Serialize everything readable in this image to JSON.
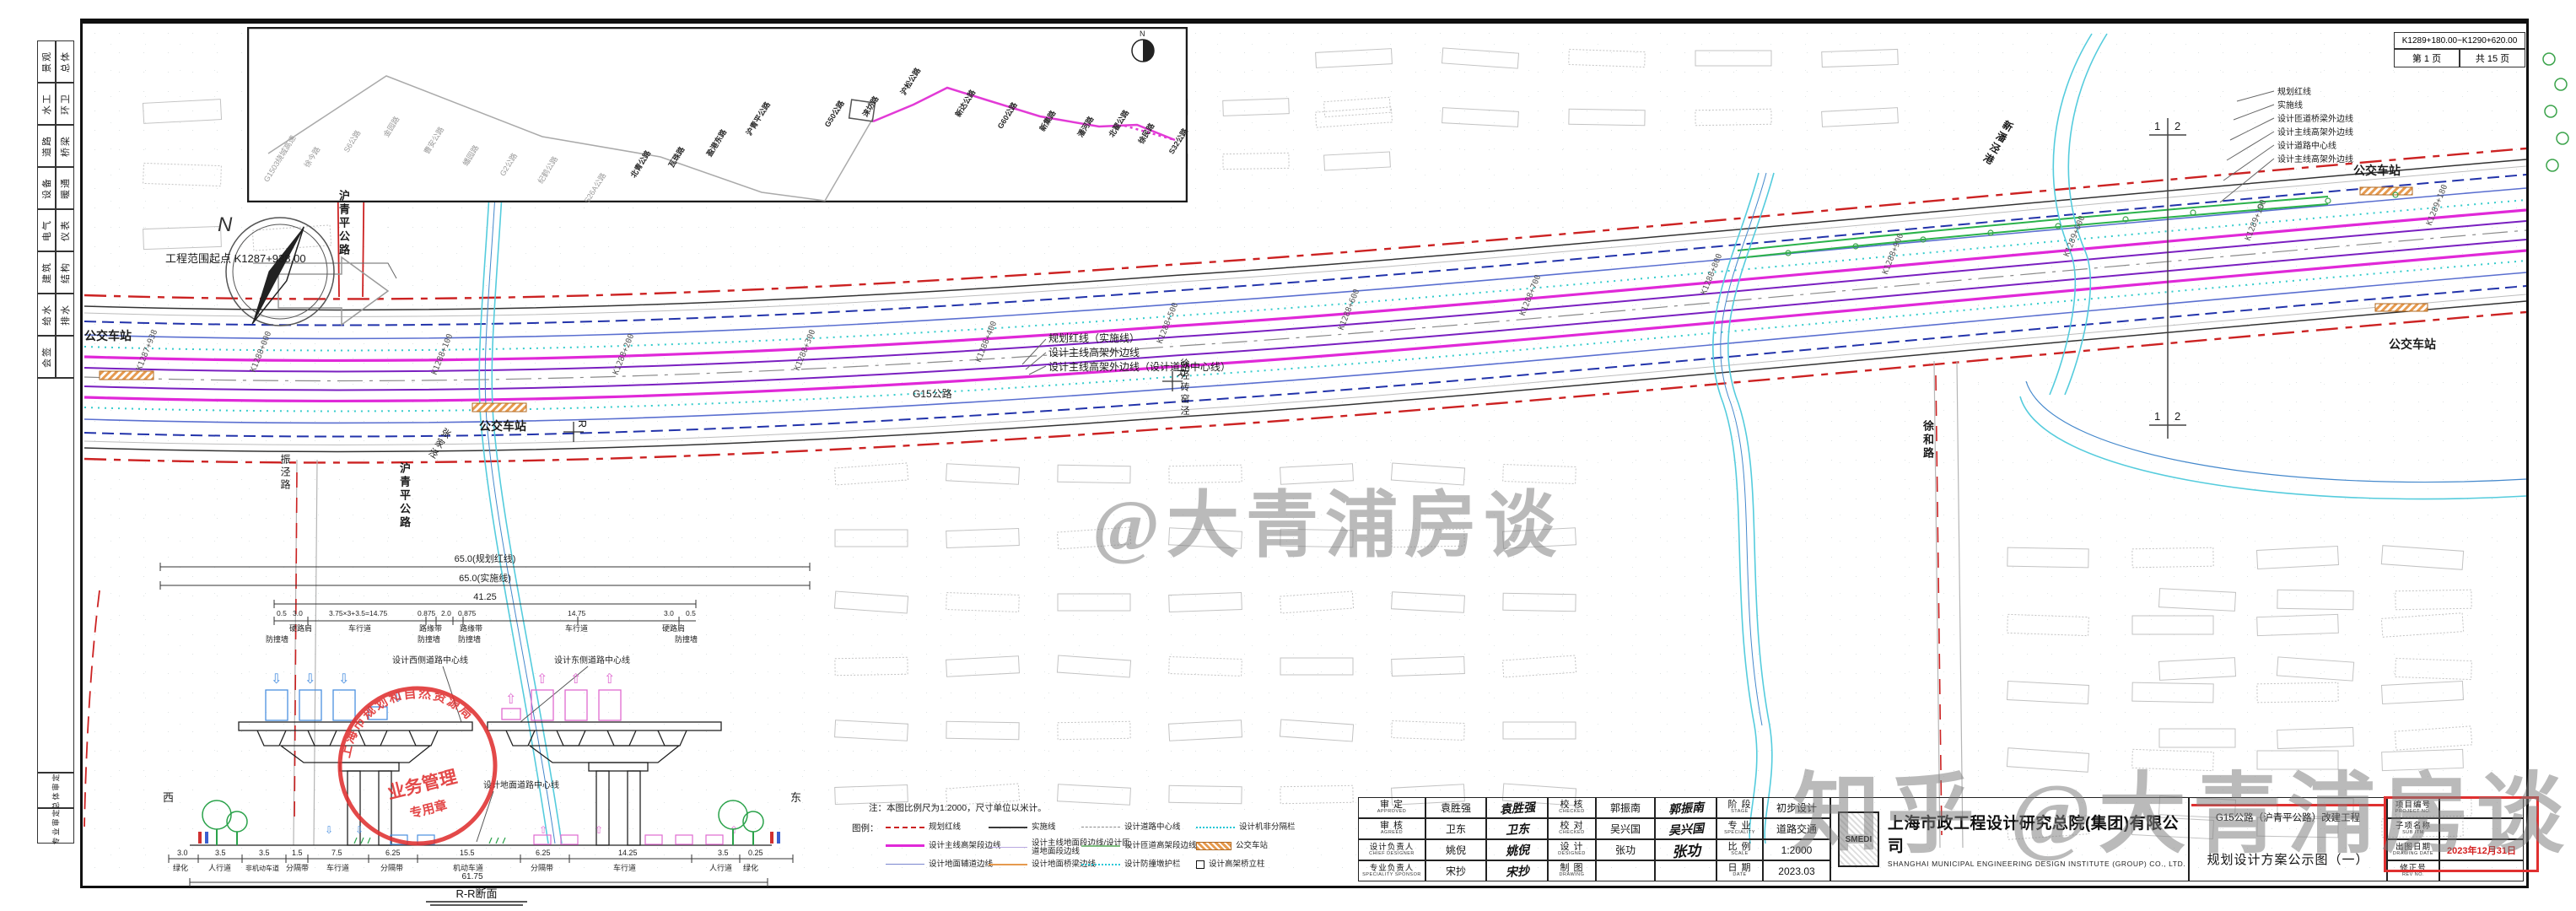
{
  "header_table": {
    "range": "K1289+180.00~K1290+620.00",
    "page": "第 1 页",
    "total": "共 15 页"
  },
  "sign_strip": {
    "rows": [
      {
        "a": "景观",
        "b": "总体"
      },
      {
        "a": "水工",
        "b": "环卫"
      },
      {
        "a": "道路",
        "b": "桥梁"
      },
      {
        "a": "设备",
        "b": "暖通"
      },
      {
        "a": "电气",
        "b": "仪表"
      },
      {
        "a": "建筑",
        "b": "结构"
      },
      {
        "a": "给水",
        "b": "排水"
      },
      {
        "a": "会签",
        "b": ""
      }
    ],
    "bottom": [
      "总体审定",
      "专业审定"
    ]
  },
  "inset": {
    "compass": "N",
    "roads": [
      "G1503绕城高速",
      "徐今路",
      "S6公路",
      "金园路",
      "曹安公路",
      "蟠园路",
      "G2公路",
      "纪鹤公路",
      "S26A公路",
      "北青公路",
      "瓦珠路",
      "盈港东路",
      "沪青平公路",
      "G50公路",
      "涞坊路",
      "沪松公路",
      "新达公路",
      "G60公路",
      "新集路",
      "潘河路",
      "北翟公路",
      "徐民路",
      "S32公路"
    ]
  },
  "plan": {
    "start_point": "工程范围起点 K1287+938.00",
    "bus_station": "公交车站",
    "road_hqp": "沪青平公路",
    "road_zhenjing": "振泾路",
    "road_xuhe": "徐和路",
    "road_g15": "G15公路",
    "river_zjj": "张家泾",
    "river_xjzyj": "徐泾砖窑泾",
    "river_xpjg": "新潘泾港",
    "r_marker": "R",
    "match_left": "1",
    "match_right": "2",
    "compass_n": "N",
    "leader_right": [
      "规划红线",
      "实施线",
      "设计匝道桥梁外边线",
      "设计主线高架外边线",
      "设计道路中心线",
      "设计主线高架外边线"
    ],
    "leader_center": [
      "规划红线（实施线）",
      "设计主线高架外边线",
      "设计主线高架外边线（设计道路中心线）"
    ],
    "chainages": [
      "K1287+938",
      "K1288+000",
      "K1288+100",
      "K1288+200",
      "K1288+300",
      "K1288+400",
      "K1288+500",
      "K1288+600",
      "K1288+700",
      "K1288+800",
      "K1288+900",
      "K1289+000",
      "K1289+100",
      "K1289+180"
    ]
  },
  "xsec": {
    "dim_red": "65.0(规划红线)",
    "dim_impl": "65.0(实施线)",
    "dim_mid": "41.25",
    "lane_dims": [
      "0.5",
      "3.0",
      "3.75×3+3.5=14.75",
      "0.875",
      "2.0",
      "0.875",
      "14.75",
      "3.0",
      "0.5"
    ],
    "lane_names": [
      "硬路肩",
      "车行道",
      "路缘带",
      "路缘带",
      "车行道",
      "硬路肩"
    ],
    "wall_name": "防撞墙",
    "center_west": "设计西侧道路中心线",
    "center_east": "设计东侧道路中心线",
    "center_ground": "设计地面道路中心线",
    "west": "西",
    "east": "东",
    "bottom_dims": [
      "3.0",
      "3.5",
      "3.5",
      "1.5",
      "7.5",
      "6.25",
      "15.5",
      "6.25",
      "14.25",
      "3.5",
      "0.25"
    ],
    "bottom_names": [
      "绿化",
      "人行道",
      "非机动车道",
      "分隔带",
      "车行道",
      "分隔带",
      "机动车道",
      "分隔带",
      "车行道",
      "人行道",
      "绿化"
    ],
    "total_dim": "61.75",
    "title": "R-R断面",
    "stamp": {
      "arc": "上海市规划和自然资源局",
      "line2": "业务管理",
      "line3": "专用章"
    }
  },
  "legend": {
    "note": "注：本图比例尺为1:2000，尺寸单位以米计。",
    "caption": "图例：",
    "items": [
      {
        "label": "规划红线"
      },
      {
        "label": "实施线"
      },
      {
        "label": "设计道路中心线"
      },
      {
        "label": "设计机非分隔栏"
      },
      {
        "label": "设计主线高架段边线"
      },
      {
        "label": "设计主线地面段边线/设计匝道地面段边线"
      },
      {
        "label": "设计匝道高架段边线"
      },
      {
        "label": "公交车站"
      },
      {
        "label": "设计地面辅道边线"
      },
      {
        "label": "设计地面桥梁边线"
      },
      {
        "label": "设计防撞墩护栏"
      },
      {
        "label": "设计高架桥立柱"
      }
    ]
  },
  "titleblock": {
    "approvals": [
      {
        "role": "审 定",
        "en": "APPROVED",
        "name": "袁胜强"
      },
      {
        "role": "审 核",
        "en": "AGREED",
        "name": "卫东"
      },
      {
        "role": "设计负责人",
        "en": "CHIEF DESIGNER",
        "name": "姚倪"
      },
      {
        "role": "专业负责人",
        "en": "SPECIALITY SPONSOR",
        "name": "宋抄"
      }
    ],
    "checks": [
      {
        "role": "校 核",
        "en": "CHECKED",
        "name": "郭振南"
      },
      {
        "role": "校 对",
        "en": "CHECKED",
        "name": "吴兴国"
      },
      {
        "role": "设 计",
        "en": "DESIGNED",
        "name": "张功"
      },
      {
        "role": "制 图",
        "en": "DRAWING",
        "name": ""
      }
    ],
    "stage": [
      {
        "k": "阶 段",
        "en": "STAGE",
        "v": "初步设计"
      },
      {
        "k": "专 业",
        "en": "SPECIALITY",
        "v": "道路交通"
      },
      {
        "k": "比 例",
        "en": "SCALE",
        "v": "1:2000"
      },
      {
        "k": "日 期",
        "en": "DATE",
        "v": "2023.03"
      }
    ],
    "company": {
      "logo": "SMEDI",
      "cn": "上海市政工程设计研究总院(集团)有限公司",
      "en": "SHANGHAI MUNICIPAL ENGINEERING DESIGN INSTITUTE (GROUP) CO., LTD."
    },
    "project": "G15公路（沪青平公路）改建工程",
    "drawing": "规划设计方案公示图（一）",
    "right": [
      {
        "k": "项目编号",
        "en": "PROJECT NO.",
        "v": ""
      },
      {
        "k": "子项名称",
        "en": "SUB ITM",
        "v": ""
      },
      {
        "k": "出图日期",
        "en": "DRAWING DATE",
        "v": "2023年12月31日"
      },
      {
        "k": "修正号",
        "en": "REV NO.",
        "v": ""
      }
    ]
  },
  "watermarks": {
    "center": "@大青浦房谈",
    "bottom": "知乎 @大青浦房谈"
  },
  "colors": {
    "red_line": "#cc2222",
    "magenta": "#e028d8",
    "purple": "#7a1fc0",
    "navy": "#2233aa",
    "slate": "#5a6fd0",
    "cyan": "#33cccc",
    "green": "#2ab24a",
    "orange": "#e08a30",
    "stamp_red": "#e03030"
  }
}
